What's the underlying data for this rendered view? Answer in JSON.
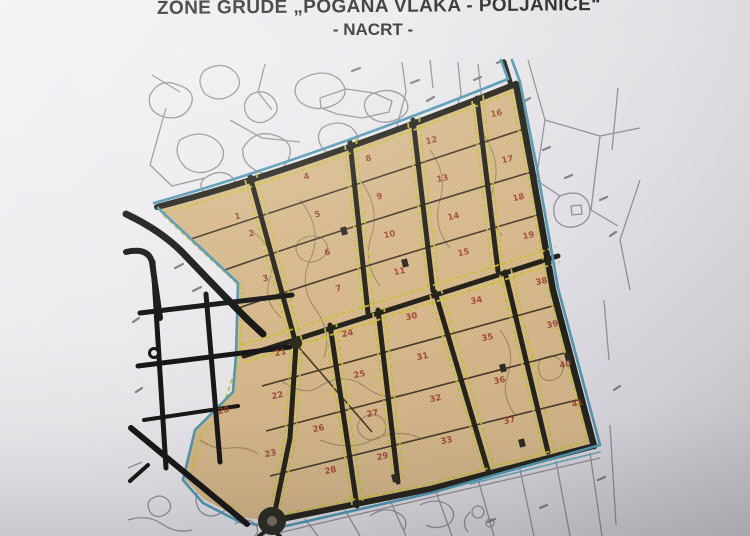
{
  "document": {
    "title_line1": "ZONE GRUDE „POGANA VLAKA - POLJANICE“",
    "title_line2": "- NACRT -"
  },
  "map": {
    "description": "Cadastral development plan drawing of a zone with 41 numbered building parcels",
    "colors": {
      "parcel_fill": "#d9bb8d",
      "zone_boundary": "#4e98b4",
      "road": "#24231a",
      "dashed_line": "#c3c32b",
      "parcel_number": "#9d3b2d",
      "background_linework": "#8e8d92"
    },
    "parcels": [
      {
        "n": 1,
        "x": 238,
        "y": 219
      },
      {
        "n": 2,
        "x": 252,
        "y": 236
      },
      {
        "n": 3,
        "x": 266,
        "y": 281
      },
      {
        "n": 4,
        "x": 307,
        "y": 179
      },
      {
        "n": 5,
        "x": 318,
        "y": 217
      },
      {
        "n": 6,
        "x": 328,
        "y": 255
      },
      {
        "n": 7,
        "x": 339,
        "y": 291
      },
      {
        "n": 8,
        "x": 369,
        "y": 161
      },
      {
        "n": 9,
        "x": 380,
        "y": 199
      },
      {
        "n": 10,
        "x": 390,
        "y": 237
      },
      {
        "n": 11,
        "x": 400,
        "y": 274
      },
      {
        "n": 12,
        "x": 432,
        "y": 143
      },
      {
        "n": 13,
        "x": 443,
        "y": 181
      },
      {
        "n": 14,
        "x": 454,
        "y": 219
      },
      {
        "n": 15,
        "x": 464,
        "y": 255
      },
      {
        "n": 16,
        "x": 497,
        "y": 116
      },
      {
        "n": 17,
        "x": 508,
        "y": 162
      },
      {
        "n": 18,
        "x": 519,
        "y": 200
      },
      {
        "n": 19,
        "x": 529,
        "y": 238
      },
      {
        "n": 20,
        "x": 224,
        "y": 413
      },
      {
        "n": 21,
        "x": 281,
        "y": 355
      },
      {
        "n": 22,
        "x": 278,
        "y": 398
      },
      {
        "n": 23,
        "x": 271,
        "y": 456
      },
      {
        "n": 24,
        "x": 348,
        "y": 336
      },
      {
        "n": 25,
        "x": 360,
        "y": 377
      },
      {
        "n": 26,
        "x": 319,
        "y": 431
      },
      {
        "n": 27,
        "x": 373,
        "y": 416
      },
      {
        "n": 28,
        "x": 331,
        "y": 473
      },
      {
        "n": 29,
        "x": 383,
        "y": 459
      },
      {
        "n": 30,
        "x": 412,
        "y": 319
      },
      {
        "n": 31,
        "x": 423,
        "y": 359
      },
      {
        "n": 32,
        "x": 436,
        "y": 401
      },
      {
        "n": 33,
        "x": 447,
        "y": 443
      },
      {
        "n": 34,
        "x": 477,
        "y": 303
      },
      {
        "n": 35,
        "x": 488,
        "y": 340
      },
      {
        "n": 36,
        "x": 500,
        "y": 383
      },
      {
        "n": 37,
        "x": 510,
        "y": 423
      },
      {
        "n": 38,
        "x": 542,
        "y": 284
      },
      {
        "n": 39,
        "x": 553,
        "y": 327
      },
      {
        "n": 40,
        "x": 566,
        "y": 367
      },
      {
        "n": 41,
        "x": 578,
        "y": 406
      }
    ]
  }
}
